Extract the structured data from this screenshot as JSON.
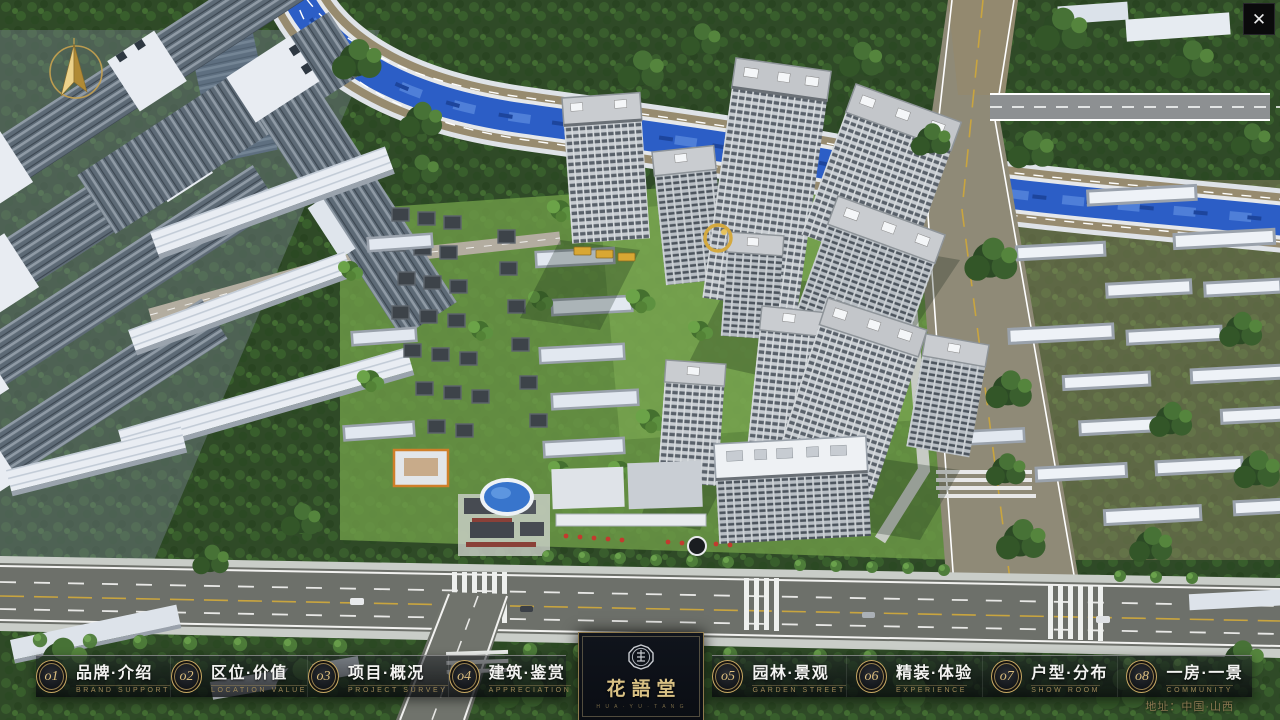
{
  "window": {
    "close_glyph": "✕"
  },
  "nav": {
    "items": [
      {
        "num": "o1",
        "label": "品牌·介绍",
        "caption": "BRAND SUPPORT"
      },
      {
        "num": "o2",
        "label": "区位·价值",
        "caption": "LOCATION VALUE"
      },
      {
        "num": "o3",
        "label": "项目·概况",
        "caption": "PROJECT SURVEY"
      },
      {
        "num": "o4",
        "label": "建筑·鉴赏",
        "caption": "APPRECIATION"
      },
      {
        "num": "o5",
        "label": "园林·景观",
        "caption": "GARDEN STREET"
      },
      {
        "num": "o6",
        "label": "精装·体验",
        "caption": "EXPERIENCE"
      },
      {
        "num": "o7",
        "label": "户型·分布",
        "caption": "SHOW ROOM"
      },
      {
        "num": "o8",
        "label": "一房·一景",
        "caption": "COMMUNITY"
      }
    ]
  },
  "logo": {
    "title": "花語堂",
    "subtitle": "H U A · Y U · T A N G"
  },
  "footer": {
    "address": "地址：中国·山西"
  },
  "colors": {
    "gold": "#c7a863",
    "river": "#2c5ec6",
    "tree": "#2c4a25"
  }
}
